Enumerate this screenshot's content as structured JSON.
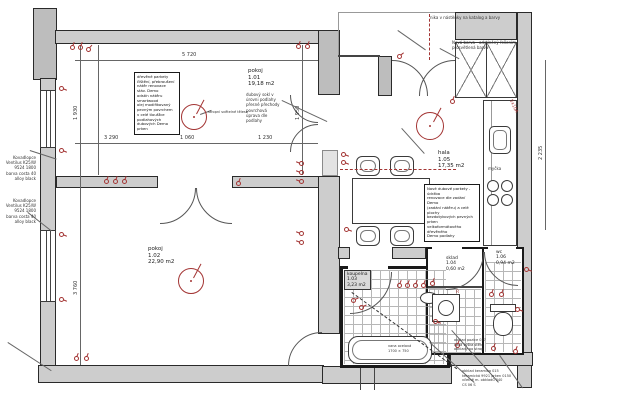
{
  "drawing_type": "apartment floor plan (CAD, Czech labels)",
  "colors": {
    "accent_red": "#a33433",
    "wall_gray": "#cdcdcd",
    "dark_wall_gray": "#bdbdbd",
    "line": "#2a2a2a"
  },
  "rooms": [
    {
      "name": "pokoj",
      "number": "1.01",
      "area": "19,18 m2"
    },
    {
      "name": "pokoj",
      "number": "1.02",
      "area": "22,90 m2"
    },
    {
      "name": "koupelna",
      "number": "1.03",
      "area": "3,23 m2"
    },
    {
      "name": "sklad",
      "number": "1.04",
      "area": "0,60 m2"
    },
    {
      "name": "hala",
      "number": "1.05",
      "area": "17,35 m2"
    },
    {
      "name": "wc",
      "number": "1.06",
      "area": "0,94 m2"
    }
  ],
  "notes": {
    "room1_spec": "dřevěné parkety\nčištění, přebroušení\nnátěr renovace\nstáv. Demo\nodstín nátěru\nsmartwood\nolej modifikovaný\npevným povrchem\nv celé tloušťce\npodlahových\ndubových Demo\nprken",
    "hala_spec": "Nové dubové parkety - údržba\nrenovace dle zadání Demo\n(zadání nátěru) a celé plochy\nbezdotykových pevných prken\nvelkoformátového dřevěného\nDemo podlahy",
    "room1_note": "dubový sokl v\núrovni podlahy\npřesné přechody\npovrchová\núprava dle\npodlahy",
    "light_note": "stropní světelné těleso",
    "bath_tub": "vana ocelová\n1700 × 750",
    "kitchen_note": "myčka",
    "kitchen_circuit": "5x10A",
    "device_mark": "R"
  },
  "annotations": {
    "top_niche": "nika v nástěnky na katalog a barvy",
    "top_color": "Nová barva - odstíněný řešením\nprosvětlená barva",
    "window1": "Kovadlopce\nVentilus K25/W\n9524 1800\nbarva costa 40\nalloy black",
    "window2": "Kovadlopce\nVentilus K25/W\n9524 1800\nbarva costa 40\nalloy black",
    "bath1": "obklad pozice 017\nčistá výška stěn\nobklady po strop",
    "bath2": "obklad keramika 015\nkeramická 9921 prken 0150\nvčetně m. obkladů 040\nCS 06 S"
  },
  "dimensions": {
    "top": "5 720",
    "bottom_a": "3 290",
    "bottom_b": "1 060",
    "bottom_c": "1 230",
    "left_a": "1 930",
    "left_b": "3 760",
    "right_a": "1 950",
    "far_right": "2 235"
  },
  "icons": {
    "socket-icon": "small red circle with stem (electrical point)",
    "ceiling-light-icon": "red circle with stem (ceiling luminaire)",
    "door-swing-arc": "quarter-circle door swing"
  }
}
